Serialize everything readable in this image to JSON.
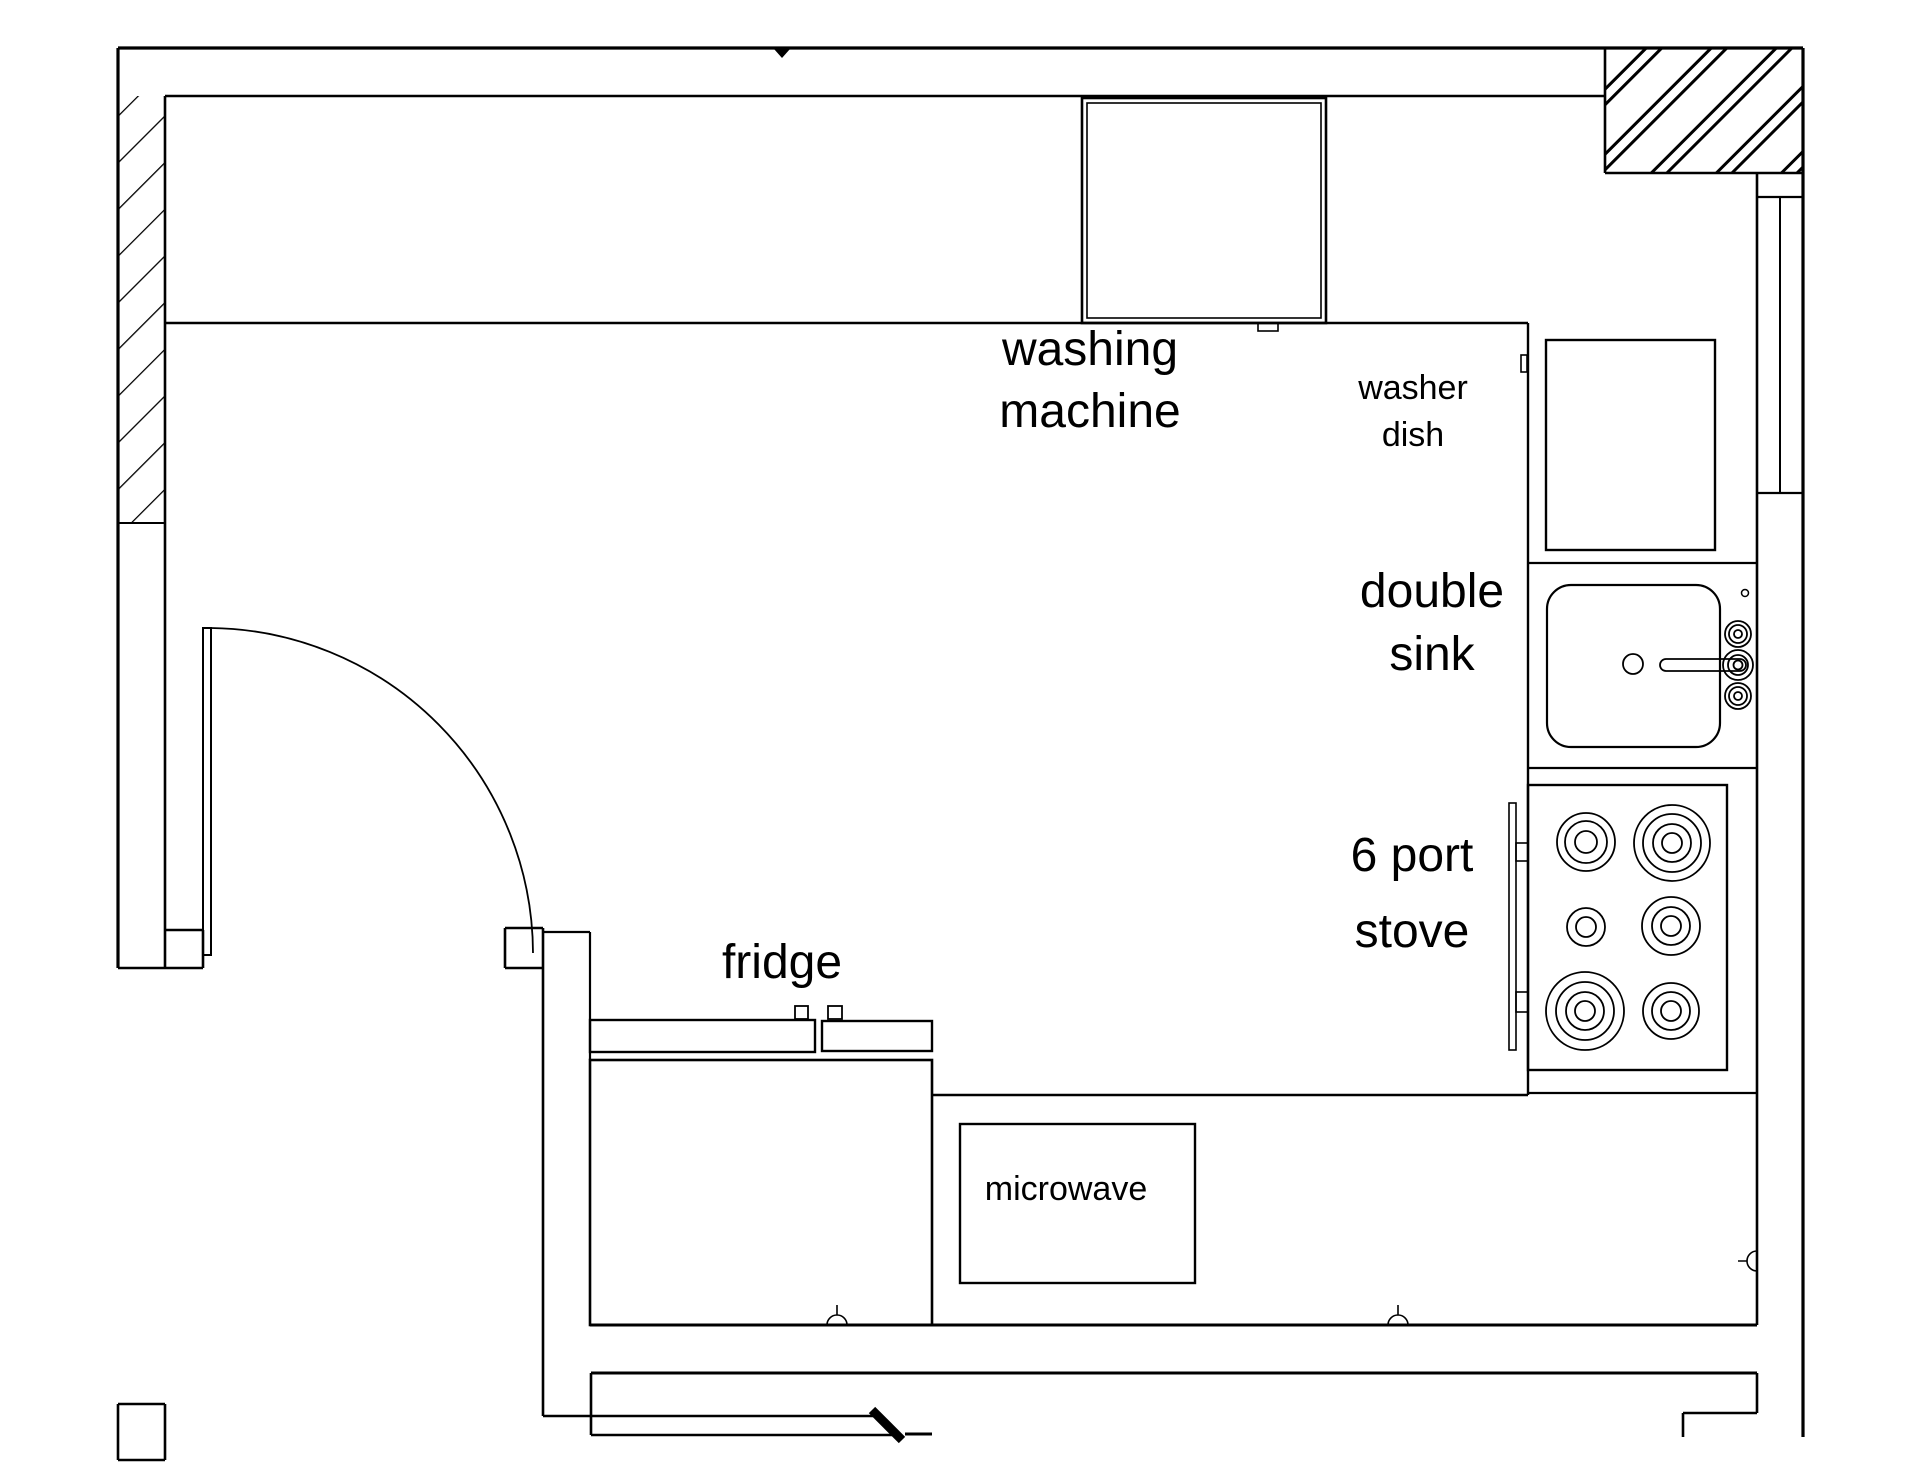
{
  "drawing": {
    "type": "kitchen-floor-plan",
    "background_color": "#ffffff",
    "line_color": "#000000"
  },
  "labels": {
    "washing_machine": {
      "line1": "washing",
      "line2": "machine"
    },
    "washer_dish": {
      "line1": "washer",
      "line2": "dish"
    },
    "double_sink": {
      "line1": "double",
      "line2": "sink"
    },
    "six_port_stove": {
      "line1": "6 port",
      "line2": "stove"
    },
    "fridge": {
      "text": "fridge"
    },
    "microwave": {
      "text": "microwave"
    }
  },
  "symbols": {
    "wall_hatch": "diagonal-hatch",
    "door": "quarter-arc-door-swing",
    "window": "double-line-window",
    "markers": [
      "plumbing-point-bottom-left",
      "plumbing-point-bottom-right",
      "plumbing-point-right-wall",
      "datum-triangle-top"
    ]
  }
}
